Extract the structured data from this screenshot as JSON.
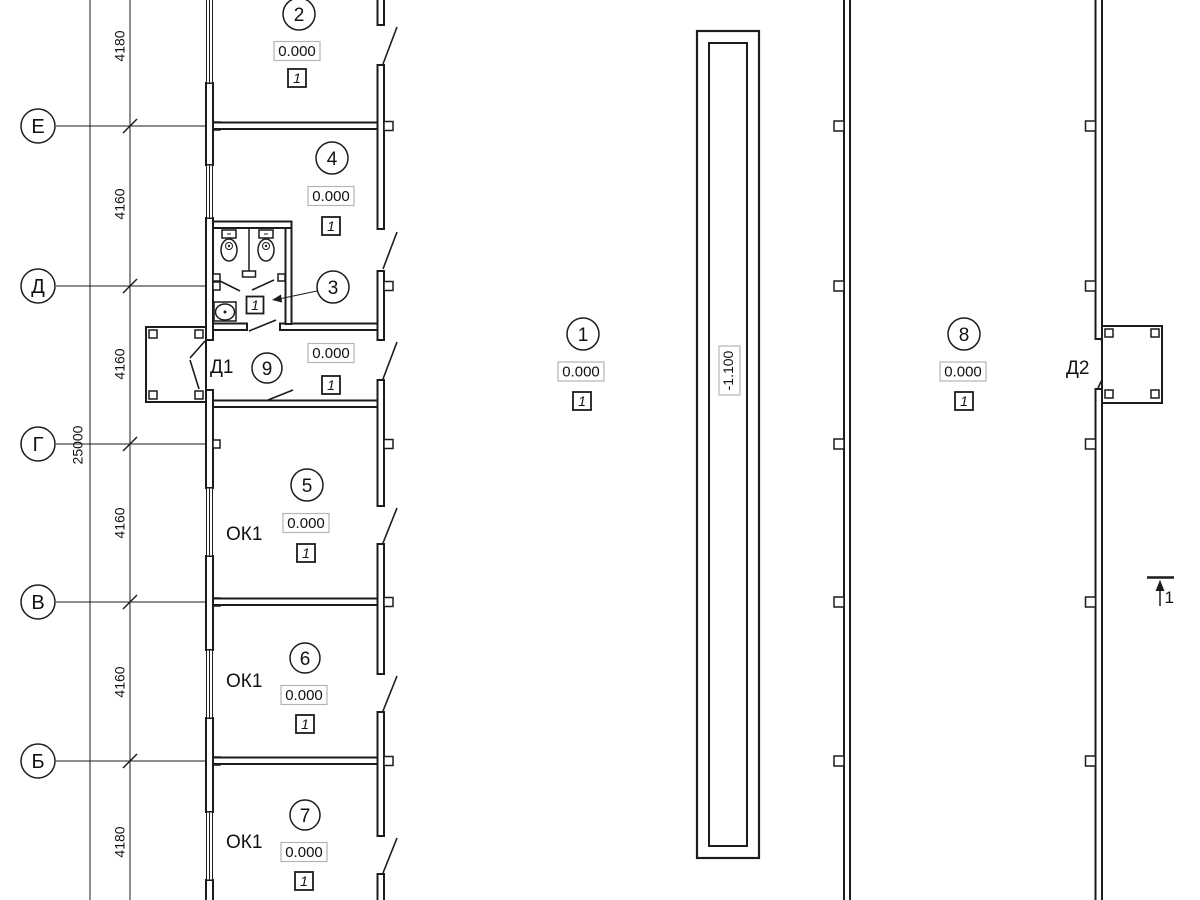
{
  "colors": {
    "line": "#1c1c1c",
    "elev_box_border": "#b5b5b5",
    "background": "#ffffff"
  },
  "axes": {
    "labels": [
      "Е",
      "Д",
      "Г",
      "В",
      "Б"
    ]
  },
  "dimensions": {
    "overall": "25000",
    "segments": [
      "4180",
      "4160",
      "4160",
      "4160",
      "4160",
      "4180"
    ]
  },
  "rooms": {
    "r2": {
      "num": "2",
      "elev": "0.000",
      "floor": "1"
    },
    "r4": {
      "num": "4",
      "elev": "0.000",
      "floor": "1"
    },
    "r3": {
      "num": "3",
      "elev": "0.000",
      "floor": "1",
      "floor_inner": "1"
    },
    "r9": {
      "num": "9"
    },
    "r5": {
      "num": "5",
      "elev": "0.000",
      "floor": "1"
    },
    "r6": {
      "num": "6",
      "elev": "0.000",
      "floor": "1"
    },
    "r7": {
      "num": "7",
      "elev": "0.000",
      "floor": "1"
    },
    "r1": {
      "num": "1",
      "elev": "0.000",
      "floor": "1"
    },
    "r8": {
      "num": "8",
      "elev": "0.000",
      "floor": "1"
    }
  },
  "labels": {
    "door1": "Д1",
    "door2": "Д2",
    "window_type": "ОК1",
    "pit_elevation": "-1.100",
    "section_mark": "1"
  }
}
